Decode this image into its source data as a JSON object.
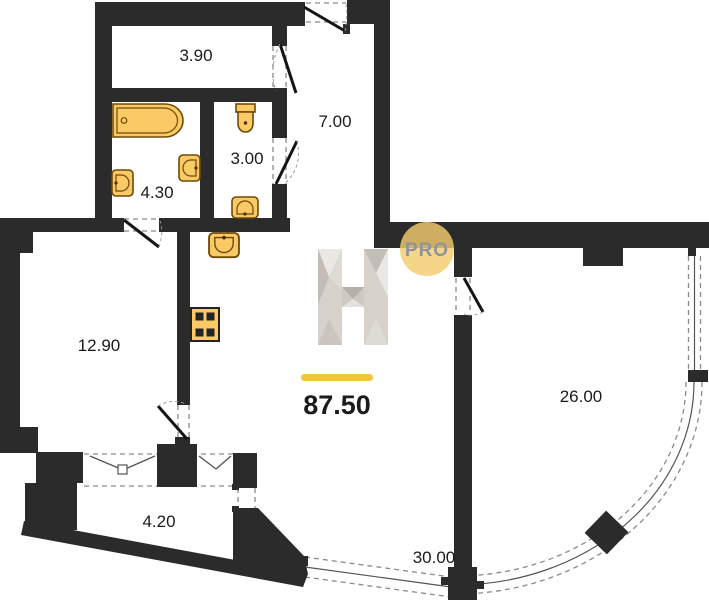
{
  "plan": {
    "total_area": "87.50",
    "badge_label": "PRO",
    "watermark_letter": "H",
    "rooms": [
      {
        "id": "wardrobe",
        "area": "3.90"
      },
      {
        "id": "hallway",
        "area": "7.00"
      },
      {
        "id": "wc",
        "area": "3.00"
      },
      {
        "id": "bathroom",
        "area": "4.30"
      },
      {
        "id": "bedroom",
        "area": "12.90"
      },
      {
        "id": "living-room",
        "area": "26.00"
      },
      {
        "id": "balcony",
        "area": "4.20"
      },
      {
        "id": "terrace",
        "area": "30.00"
      }
    ],
    "fixtures": [
      "bathtub",
      "sink",
      "sink",
      "sink",
      "kitchen-sink",
      "toilet",
      "stove"
    ],
    "colors": {
      "wall": "#2b2b2b",
      "fixture_fill": "#fbca66",
      "fixture_stroke": "#6e4a05",
      "badge_fill": "#f3cd6e",
      "badge_text": "#8e939d",
      "gold_bar": "#f2c53d",
      "label_text": "#1b1b1b",
      "glazing_dash": "#8a8a8a",
      "watermark_shades": [
        "#eae8e4",
        "#d6d1cb",
        "#c3bdb5",
        "#b7b0a7"
      ]
    }
  }
}
